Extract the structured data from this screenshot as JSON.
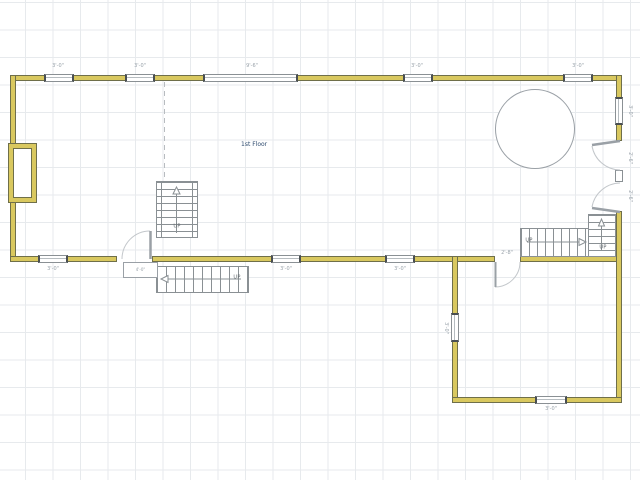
{
  "floor_plan": {
    "title": "1st Floor",
    "stair_label": "UP",
    "dimensions": {
      "t1": "3'-0\"",
      "t2": "3'-0\"",
      "t3": "9'-6\"",
      "t4": "3'-0\"",
      "t5": "3'-0\"",
      "b1": "3'-0\"",
      "b2": "3'-0\"",
      "b3": "3'-0\"",
      "r1": "3'-0\"",
      "r2": "2'-6\"",
      "r3": "2'-6\"",
      "wing_left": "3'-0\"",
      "wing_bottom": "3'-0\"",
      "door_wing": "2'-8\"",
      "stoop": "4'-0\""
    },
    "colors": {
      "wall_fill": "#d9c85f",
      "wall_edge": "#6f6f4a",
      "grid": "#e7eaed",
      "stair_line": "#8a9094",
      "door_arc": "#c3c7cb",
      "title_color": "#2d4a6e",
      "dim_color": "#98a1a9"
    }
  }
}
